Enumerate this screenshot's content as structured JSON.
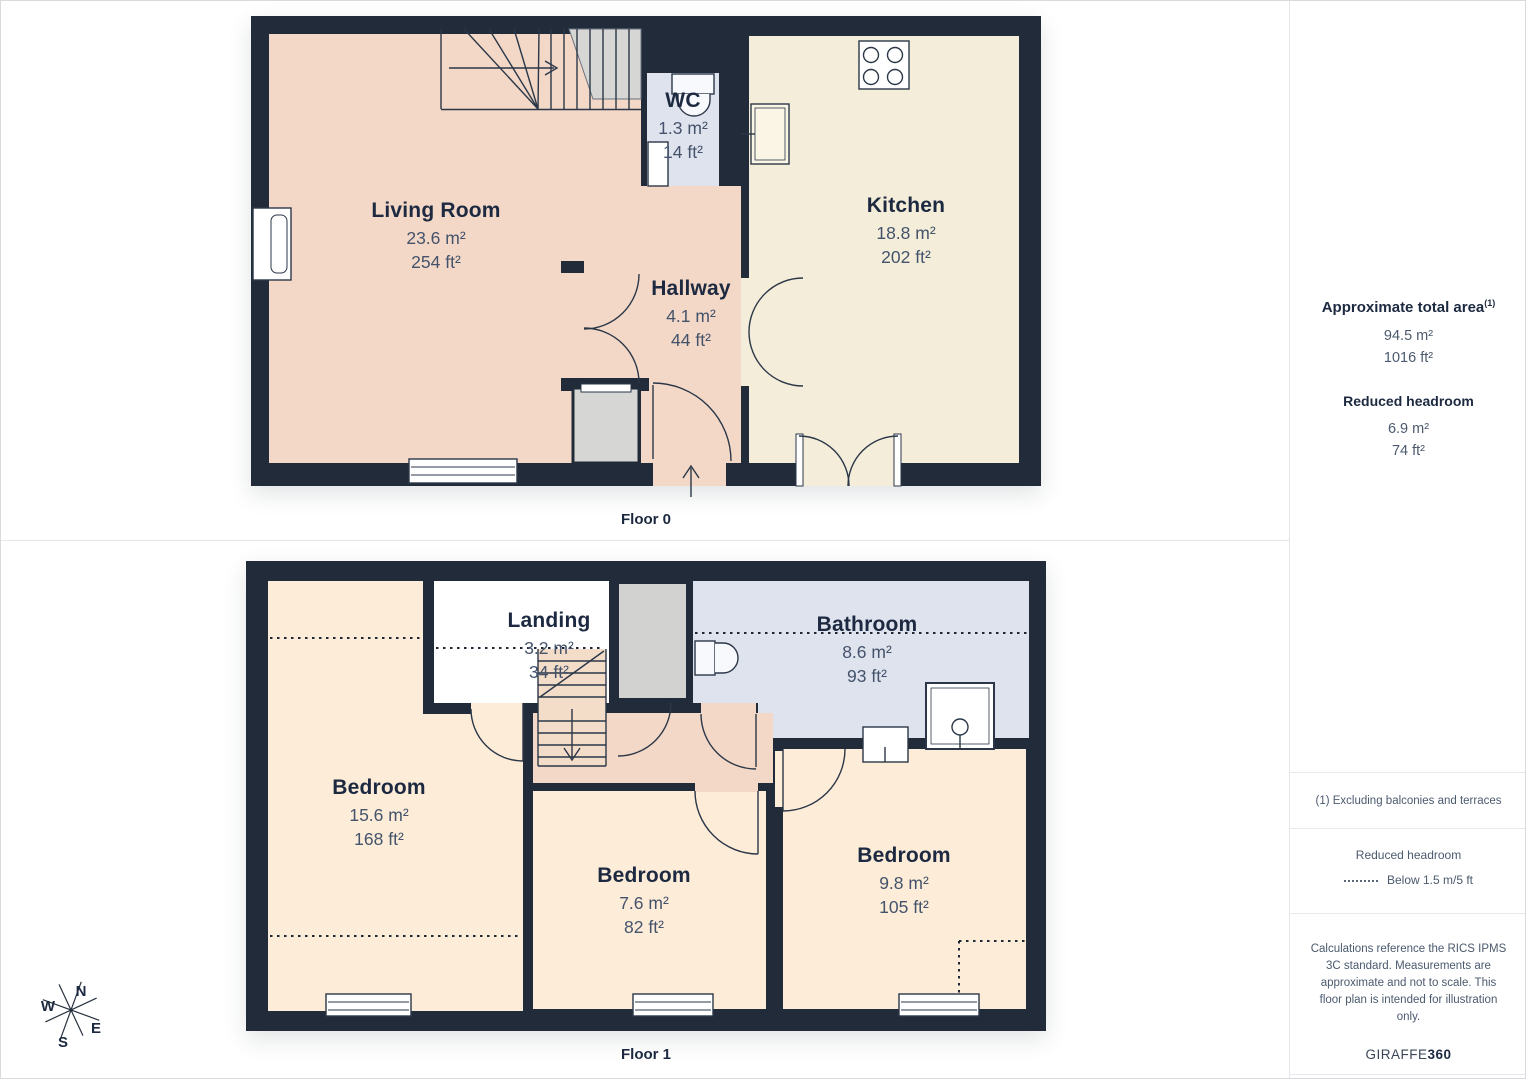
{
  "floor0": {
    "label": "Floor 0",
    "rooms": {
      "living": {
        "name": "Living Room",
        "m2": "23.6 m²",
        "ft2": "254 ft²"
      },
      "wc": {
        "name": "WC",
        "m2": "1.3 m²",
        "ft2": "14 ft²"
      },
      "kitchen": {
        "name": "Kitchen",
        "m2": "18.8 m²",
        "ft2": "202 ft²"
      },
      "hallway": {
        "name": "Hallway",
        "m2": "4.1 m²",
        "ft2": "44 ft²"
      }
    }
  },
  "floor1": {
    "label": "Floor 1",
    "rooms": {
      "landing": {
        "name": "Landing",
        "m2": "3.2 m²",
        "ft2": "34 ft²"
      },
      "bathroom": {
        "name": "Bathroom",
        "m2": "8.6 m²",
        "ft2": "93 ft²"
      },
      "bedroom_left": {
        "name": "Bedroom",
        "m2": "15.6 m²",
        "ft2": "168 ft²"
      },
      "bedroom_middle": {
        "name": "Bedroom",
        "m2": "7.6 m²",
        "ft2": "82 ft²"
      },
      "bedroom_right": {
        "name": "Bedroom",
        "m2": "9.8 m²",
        "ft2": "105 ft²"
      }
    }
  },
  "compass": {
    "north": "N",
    "east": "E",
    "south": "S",
    "west": "W"
  },
  "sidebar": {
    "total_area": {
      "title": "Approximate total area",
      "footnote_marker": "(1)",
      "m2": "94.5 m²",
      "ft2": "1016 ft²"
    },
    "reduced_headroom": {
      "title": "Reduced headroom",
      "m2": "6.9 m²",
      "ft2": "74 ft²"
    },
    "footnote": "(1) Excluding balconies and terraces",
    "legend": {
      "title": "Reduced headroom",
      "label": "Below 1.5 m/5 ft"
    },
    "disclaimer": "Calculations reference the RICS IPMS 3C standard. Measurements are approximate and not to scale. This floor plan is intended for illustration only.",
    "brand": {
      "name": "GIRAFFE",
      "suffix": "360"
    }
  },
  "colors": {
    "wall": "#212b3a",
    "living_pink": "#f3d8c7",
    "kitchen_cream": "#f3edd9",
    "bedroom_peach": "#fcecd8",
    "bathroom_blue": "#dfe3ed",
    "stairs_grey": "#d2d2d0",
    "text_dark": "#1c2940",
    "text_muted": "#44536b"
  }
}
